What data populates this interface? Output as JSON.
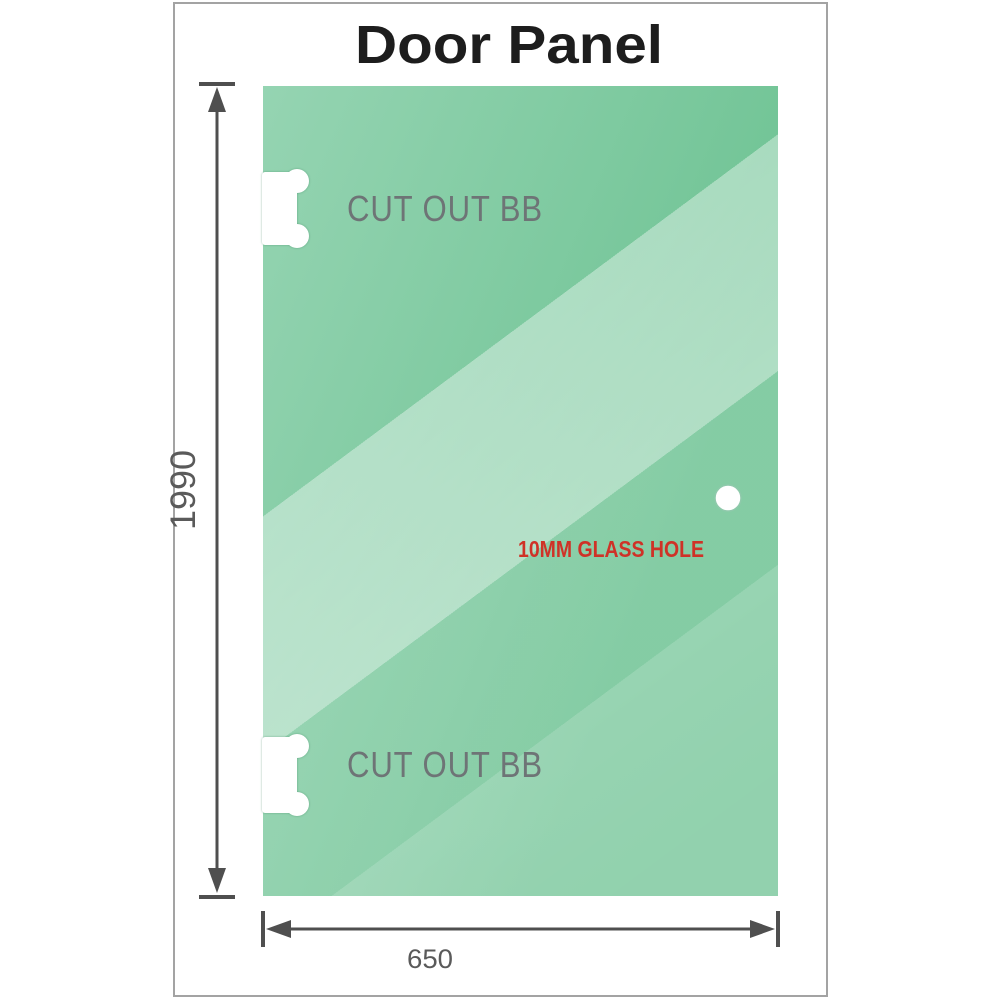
{
  "page": {
    "title": "Door Panel"
  },
  "panel": {
    "type": "glass door panel drawing",
    "cutouts": [
      {
        "label": "CUT OUT BB",
        "position": "top-left edge"
      },
      {
        "label": "CUT OUT BB",
        "position": "bottom-left edge"
      }
    ],
    "hole": {
      "label": "10MM GLASS HOLE",
      "diameter_label": "10MM"
    }
  },
  "dimensions": {
    "height_label": "1990",
    "width_label": "650"
  },
  "colors": {
    "title_text": "#1d1d1d",
    "cutout_label": "#6e7476",
    "dimension_label": "#5a5a5a",
    "hole_label": "#cf3227",
    "dimension_lines": "#4f4f4f",
    "frame_border": "#a3a3a3",
    "glass_green_dark": "#6fc394",
    "glass_green_light": "#c9ecd9",
    "glass_green_base": "#95d4b2",
    "cutout_fill": "#ffffff"
  }
}
